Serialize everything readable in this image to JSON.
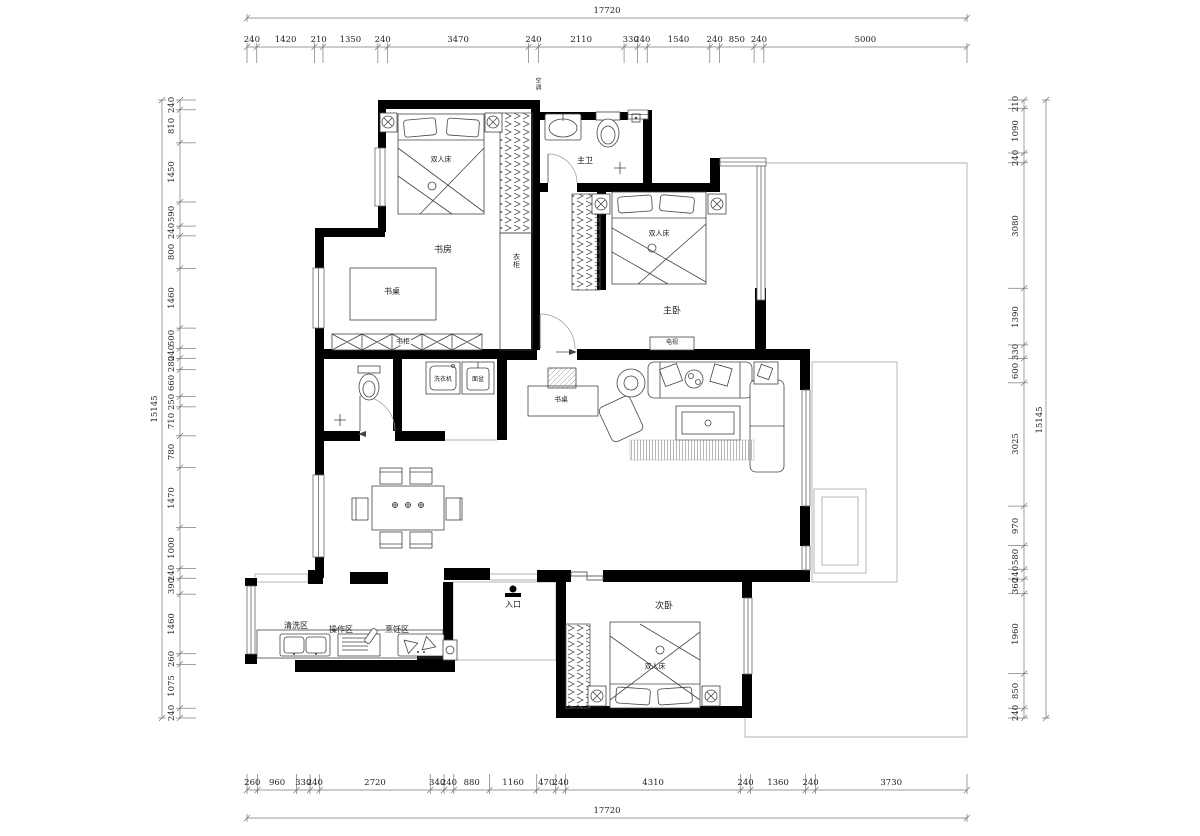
{
  "rooms": {
    "study": "书房",
    "master_bath": "主卫",
    "master_bed": "主卧",
    "second_bed": "次卧",
    "entry": "入口",
    "wash_zone": "清洗区",
    "prep_zone": "操作区",
    "cook_zone": "烹饪区"
  },
  "furniture": {
    "double_bed": "双人床",
    "desk": "书桌",
    "bookcase": "书柜",
    "wardrobe": "衣柜",
    "ac": "空调",
    "tv": "电视",
    "washer": "洗衣机",
    "basin": "面盆"
  },
  "colors": {
    "wall": "#000000",
    "line": "#999999",
    "background": "#ffffff"
  },
  "dims": {
    "top": {
      "total": "17720",
      "segments": [
        240,
        1420,
        210,
        1350,
        240,
        3470,
        240,
        2110,
        330,
        240,
        1540,
        240,
        850,
        240,
        5000
      ]
    },
    "bottom": {
      "total": "17720",
      "segments": [
        260,
        960,
        330,
        240,
        2720,
        340,
        240,
        880,
        1160,
        470,
        240,
        4310,
        240,
        1360,
        240,
        3730
      ]
    },
    "left": {
      "total": "15145",
      "segments": [
        240,
        810,
        1450,
        590,
        240,
        800,
        1460,
        500,
        240,
        280,
        660,
        250,
        710,
        780,
        1470,
        1000,
        240,
        390,
        1460,
        260,
        1075,
        240
      ]
    },
    "right": {
      "total": "15145",
      "segments": [
        210,
        1090,
        240,
        3080,
        1390,
        330,
        600,
        3025,
        970,
        580,
        240,
        360,
        1960,
        850,
        240
      ]
    }
  }
}
